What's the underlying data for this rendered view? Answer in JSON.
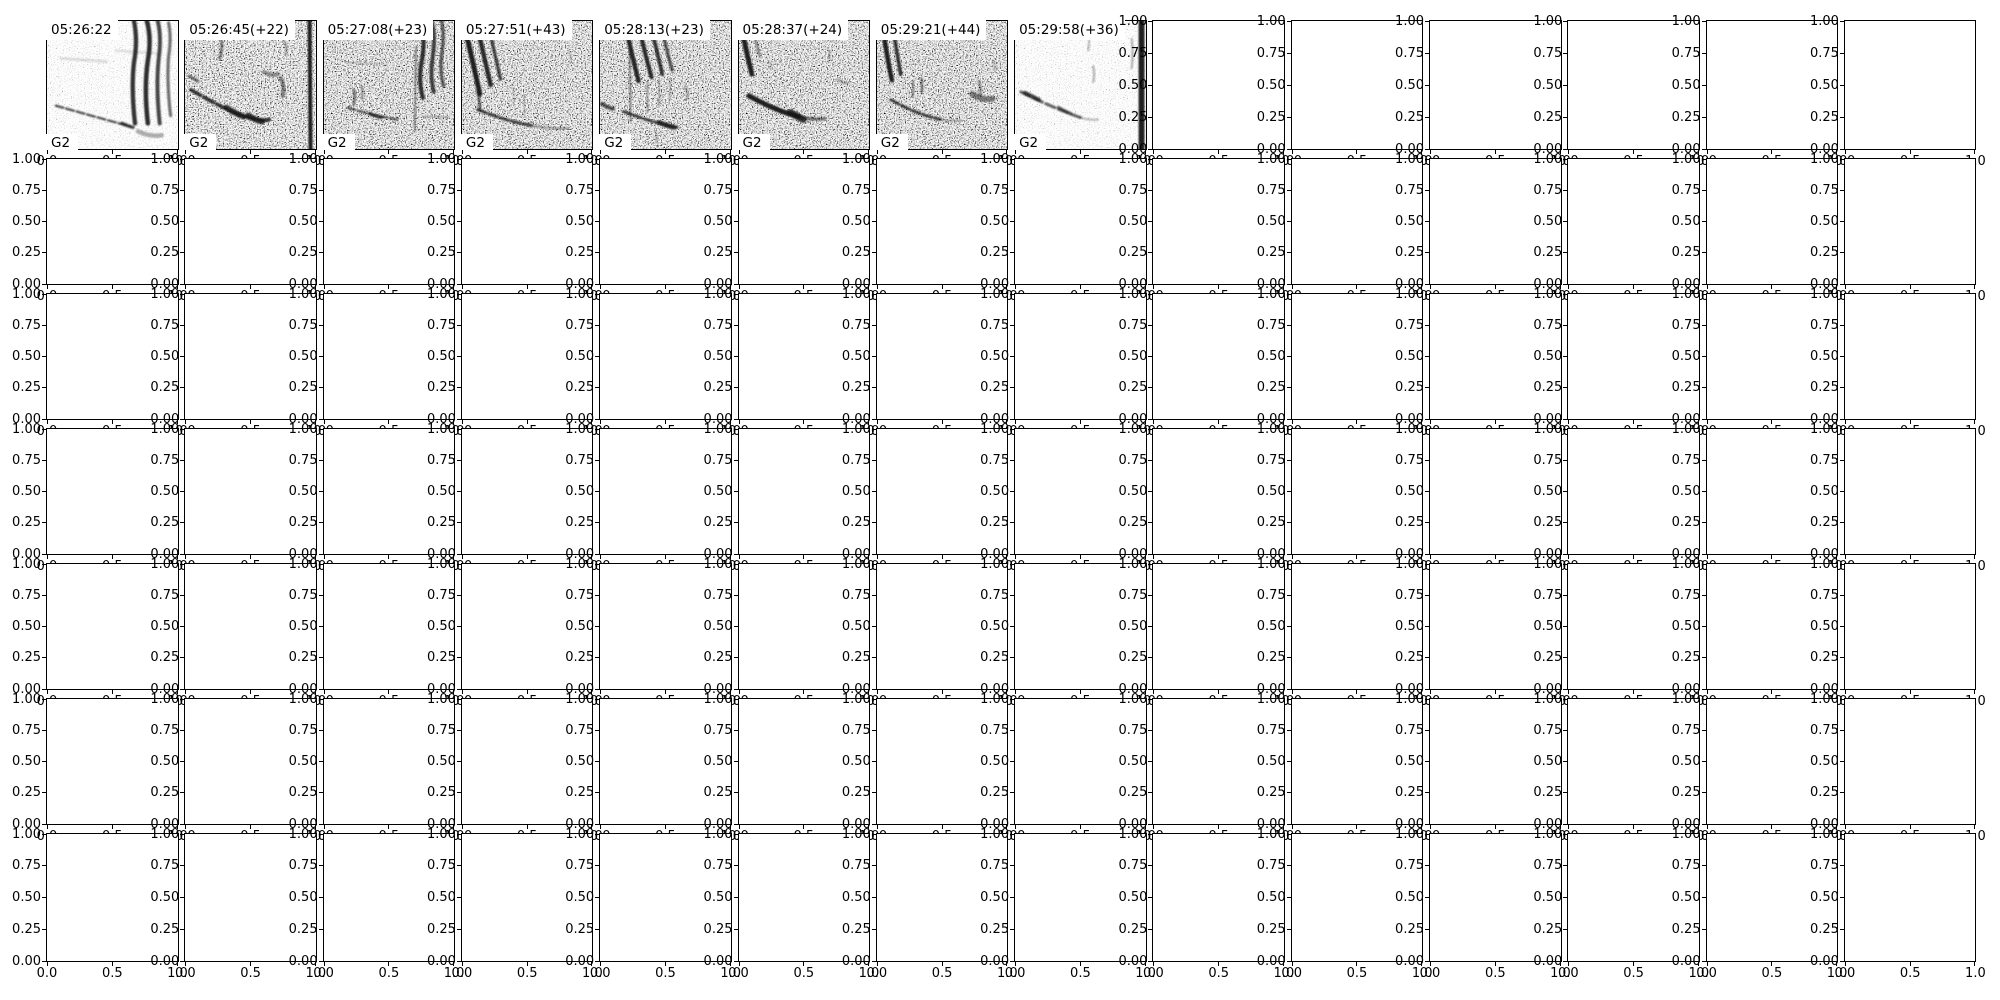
{
  "figure": {
    "background": "#ffffff"
  },
  "colors": {
    "spine": "#000000",
    "tick_text": "#000000",
    "ink": "#151515",
    "label_bg": "#ffffff"
  },
  "chart_data": {
    "type": "heatmap",
    "title": "",
    "description": "Grid of bird-song spectrogram clips (top row) above empty unit axes",
    "grid_rows": 7,
    "grid_cols": 14,
    "axes_defaults": {
      "xlim": [
        0.0,
        1.0
      ],
      "ylim": [
        0.0,
        1.0
      ],
      "xticks": [
        0.0,
        0.5,
        1.0
      ],
      "xtick_labels": [
        "0.0",
        "0.5",
        "1.0"
      ],
      "yticks": [
        1.0,
        0.75,
        0.5,
        0.25,
        0.0
      ],
      "ytick_labels": [
        "1.00",
        "0.75",
        "0.50",
        "0.25",
        "0.00"
      ],
      "grid_lines": false,
      "legend": "none"
    },
    "empty_subplot_count": 90,
    "spectrogram_panels": [
      {
        "row": 0,
        "col": 0,
        "timestamp": "05:26:22",
        "group_label": "G2",
        "noise": "light",
        "strokes": [
          {
            "d": "M9,86 C30,92 55,99 84,107",
            "w": 2.4,
            "o": 0.7,
            "dash": "8 3"
          },
          {
            "d": "M76,104 q7,3 11,4",
            "w": 3.4,
            "o": 0.75
          },
          {
            "d": "M88,0 q4,20 0,42 q-3,26 1,62",
            "w": 4.4,
            "o": 0.88
          },
          {
            "d": "M101,0 q5,18 1,40 q-4,28 0,64",
            "w": 4.6,
            "o": 0.9
          },
          {
            "d": "M112,0 q4,16 1,38 q-3,28 1,66",
            "w": 4.0,
            "o": 0.8
          },
          {
            "d": "M123,2 q3,14 0,34 q-2,26 2,60",
            "w": 3.2,
            "o": 0.6
          },
          {
            "d": "M92,112 q12,6 24,4",
            "w": 4.5,
            "o": 0.35
          },
          {
            "d": "M14,38 L60,41",
            "w": 3.0,
            "o": 0.12
          },
          {
            "d": "M70,30 L112,33",
            "w": 3.0,
            "o": 0.1
          }
        ]
      },
      {
        "row": 0,
        "col": 1,
        "timestamp": "05:26:45(+22)",
        "group_label": "G2",
        "noise": "heavy",
        "strokes": [
          {
            "d": "M6,70 C20,78 34,86 50,93 C64,99 76,102 86,100",
            "w": 3.8,
            "o": 0.85,
            "dash": "11 4"
          },
          {
            "d": "M42,88 q9,6 17,9",
            "w": 6.0,
            "o": 0.8
          },
          {
            "d": "M64,96 q8,5 14,6",
            "w": 6.0,
            "o": 0.85
          },
          {
            "d": "M126,0 L127,130",
            "w": 4.0,
            "o": 0.95
          },
          {
            "d": "M36,16 q3,10 -1,22",
            "w": 3.0,
            "o": 0.5
          },
          {
            "d": "M80,52 q8,4 14,2",
            "w": 4.0,
            "o": 0.45
          },
          {
            "d": "M97,58 q4,8 2,18",
            "w": 4.0,
            "o": 0.5
          },
          {
            "d": "M4,56 q5,3 9,5",
            "w": 3.0,
            "o": 0.6
          },
          {
            "d": "M100,20 q4,6 2,14",
            "w": 2.5,
            "o": 0.35
          }
        ]
      },
      {
        "row": 0,
        "col": 2,
        "timestamp": "05:27:08(+23)",
        "group_label": "G2",
        "noise": "medium",
        "strokes": [
          {
            "d": "M98,0 q5,18 1,40 q-4,20 1,38",
            "w": 4.2,
            "o": 0.88
          },
          {
            "d": "M109,0 q4,16 1,36 q-3,20 1,36",
            "w": 4.0,
            "o": 0.8
          },
          {
            "d": "M119,0 q3,14 0,34 q-2,18 2,32",
            "w": 3.4,
            "o": 0.65
          },
          {
            "d": "M93,26 L92,112",
            "w": 1.6,
            "o": 0.55
          },
          {
            "d": "M24,88 C40,93 56,97 74,100",
            "w": 2.4,
            "o": 0.65,
            "dash": "8 3"
          },
          {
            "d": "M46,94 q7,3 12,4",
            "w": 3.4,
            "o": 0.75
          },
          {
            "d": "M30,70 q2,8 0,15",
            "w": 2.6,
            "o": 0.55
          },
          {
            "d": "M38,66 q2,8 0,13",
            "w": 2.0,
            "o": 0.45
          },
          {
            "d": "M22,42 L64,44",
            "w": 1.4,
            "o": 0.18
          },
          {
            "d": "M100,97 L126,98",
            "w": 2.0,
            "o": 0.28
          }
        ]
      },
      {
        "row": 0,
        "col": 3,
        "timestamp": "05:27:51(+43)",
        "group_label": "G2",
        "noise": "medium",
        "strokes": [
          {
            "d": "M5,16 q7,30 13,58",
            "w": 5.0,
            "o": 0.95
          },
          {
            "d": "M17,13 q6,26 12,52",
            "w": 4.5,
            "o": 0.9
          },
          {
            "d": "M29,15 q5,22 10,44",
            "w": 3.4,
            "o": 0.75
          },
          {
            "d": "M16,72 q2,10 2,18",
            "w": 3.0,
            "o": 0.6
          },
          {
            "d": "M16,90 C36,98 52,103 70,106",
            "w": 3.0,
            "o": 0.8,
            "dash": "9 3"
          },
          {
            "d": "M70,106 q20,4 38,3",
            "w": 2.0,
            "o": 0.4
          },
          {
            "d": "M52,66 L52,85",
            "w": 1.2,
            "o": 0.3
          },
          {
            "d": "M63,76 L63,95",
            "w": 1.2,
            "o": 0.28
          },
          {
            "d": "M108,30 q3,6 1,12",
            "w": 2.0,
            "o": 0.2
          }
        ]
      },
      {
        "row": 0,
        "col": 4,
        "timestamp": "05:28:13(+23)",
        "group_label": "G2",
        "noise": "medium",
        "strokes": [
          {
            "d": "M28,15 q5,22 11,46",
            "w": 4.4,
            "o": 0.92
          },
          {
            "d": "M41,13 q5,22 11,44",
            "w": 4.2,
            "o": 0.9
          },
          {
            "d": "M53,12 q5,20 10,42",
            "w": 3.8,
            "o": 0.85
          },
          {
            "d": "M64,14 q4,18 9,36",
            "w": 3.2,
            "o": 0.7
          },
          {
            "d": "M30,28 L31,102",
            "w": 1.6,
            "o": 0.55
          },
          {
            "d": "M48,62 L48,92",
            "w": 1.4,
            "o": 0.45
          },
          {
            "d": "M60,60 L60,87",
            "w": 1.4,
            "o": 0.4
          },
          {
            "d": "M71,58 L71,80",
            "w": 1.2,
            "o": 0.35
          },
          {
            "d": "M2,84 q6,4 11,5",
            "w": 4.0,
            "o": 0.7
          },
          {
            "d": "M24,92 C42,99 58,104 78,108",
            "w": 3.0,
            "o": 0.8,
            "dash": "8 3"
          },
          {
            "d": "M60,103 q9,4 15,5",
            "w": 5.0,
            "o": 0.8
          },
          {
            "d": "M86,66 q4,6 2,13",
            "w": 2.5,
            "o": 0.3
          },
          {
            "d": "M56,112 q2,6 1,12",
            "w": 2.0,
            "o": 0.3
          }
        ]
      },
      {
        "row": 0,
        "col": 5,
        "timestamp": "05:28:37(+24)",
        "group_label": "G2",
        "noise": "medium",
        "strokes": [
          {
            "d": "M4,14 q4,20 9,40",
            "w": 5.0,
            "o": 0.95
          },
          {
            "d": "M15,12 q3,12 6,24",
            "w": 2.6,
            "o": 0.45
          },
          {
            "d": "M10,76 C28,86 44,93 60,97",
            "w": 5.0,
            "o": 0.95
          },
          {
            "d": "M52,93 q9,5 13,7",
            "w": 7.0,
            "o": 0.85
          },
          {
            "d": "M60,97 q15,4 27,2",
            "w": 3.4,
            "o": 0.55
          },
          {
            "d": "M90,28 q3,6 1,13",
            "w": 2.0,
            "o": 0.25
          },
          {
            "d": "M100,60 q6,4 10,3",
            "w": 3.0,
            "o": 0.25
          },
          {
            "d": "M30,40 q3,4 2,10",
            "w": 2.0,
            "o": 0.2
          }
        ]
      },
      {
        "row": 0,
        "col": 6,
        "timestamp": "05:29:21(+44)",
        "group_label": "G2",
        "noise": "medium",
        "strokes": [
          {
            "d": "M7,14 q3,22 8,46",
            "w": 4.6,
            "o": 0.95
          },
          {
            "d": "M17,12 q3,20 7,42",
            "w": 3.6,
            "o": 0.85
          },
          {
            "d": "M14,80 C32,90 46,96 64,100",
            "w": 3.0,
            "o": 0.8,
            "dash": "9 3"
          },
          {
            "d": "M36,62 q1,8 0,15",
            "w": 2.0,
            "o": 0.5
          },
          {
            "d": "M45,58 q1,8 0,15",
            "w": 2.2,
            "o": 0.55
          },
          {
            "d": "M64,100 q12,2 22,1",
            "w": 2.0,
            "o": 0.35
          },
          {
            "d": "M96,74 q11,7 21,5",
            "w": 6.0,
            "o": 0.5
          },
          {
            "d": "M103,62 q3,7 1,13",
            "w": 3.0,
            "o": 0.4
          },
          {
            "d": "M118,40 q2,5 1,10",
            "w": 2.0,
            "o": 0.25
          }
        ]
      },
      {
        "row": 0,
        "col": 7,
        "timestamp": "05:29:58(+36)",
        "group_label": "G2",
        "noise": "light",
        "strokes": [
          {
            "d": "M6,72 C26,82 44,90 66,98",
            "w": 3.0,
            "o": 0.65,
            "dash": "10 4"
          },
          {
            "d": "M10,73 q8,4 14,7",
            "w": 4.4,
            "o": 0.75
          },
          {
            "d": "M44,88 q7,4 12,6",
            "w": 3.6,
            "o": 0.6
          },
          {
            "d": "M74,8 q2,10 0,22",
            "w": 2.0,
            "o": 0.3
          },
          {
            "d": "M79,46 q2,8 0,16",
            "w": 2.0,
            "o": 0.35
          },
          {
            "d": "M128,0 L128,130",
            "w": 6.0,
            "o": 0.95
          },
          {
            "d": "M118,18 q2,14 0,30",
            "w": 2.0,
            "o": 0.35
          },
          {
            "d": "M66,98 q10,3 18,2",
            "w": 2.0,
            "o": 0.3
          }
        ]
      }
    ]
  }
}
